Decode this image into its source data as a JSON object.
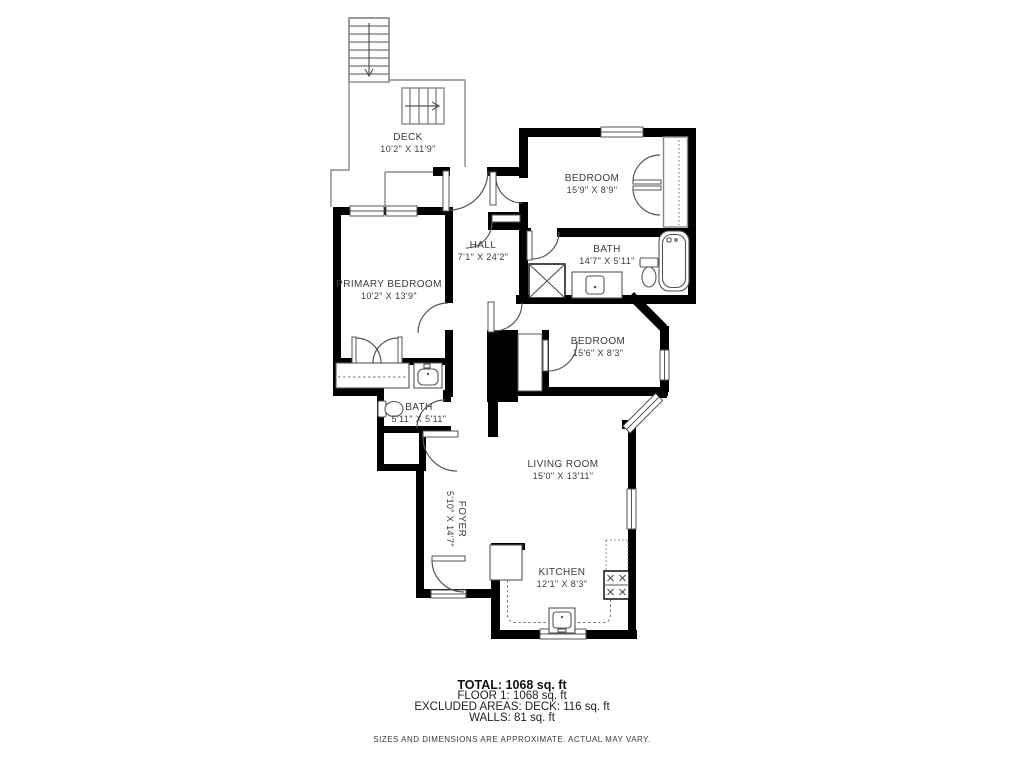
{
  "rooms": {
    "deck": {
      "name": "DECK",
      "dims": "10'2\" X 11'9\""
    },
    "bedroom_top": {
      "name": "BEDROOM",
      "dims": "15'9\" X 8'9\""
    },
    "hall": {
      "name": "HALL",
      "dims": "7'1\" X 24'2\""
    },
    "bath_top": {
      "name": "BATH",
      "dims": "14'7\" X 5'11\""
    },
    "primary_bedroom": {
      "name": "PRIMARY BEDROOM",
      "dims": "10'2\" X 13'9\""
    },
    "bedroom_mid": {
      "name": "BEDROOM",
      "dims": "15'6\" X 8'3\""
    },
    "bath_left": {
      "name": "BATH",
      "dims": "5'11\" X 5'11\""
    },
    "living_room": {
      "name": "LIVING ROOM",
      "dims": "15'0\" X 13'11\""
    },
    "foyer": {
      "name": "FOYER",
      "dims": "5'10\" X 14'7\""
    },
    "kitchen": {
      "name": "KITCHEN",
      "dims": "12'1\" X 8'3\""
    }
  },
  "summary": {
    "total": "TOTAL: 1068 sq. ft",
    "floor": "FLOOR 1: 1068 sq. ft",
    "excluded": "EXCLUDED AREAS: DECK: 116 sq. ft",
    "walls": "WALLS: 81 sq. ft",
    "disclaimer": "SIZES AND DIMENSIONS ARE APPROXIMATE. ACTUAL MAY VARY."
  },
  "palette": {
    "wall": "#000000",
    "thin_line": "#888888",
    "fixture_line": "#555555",
    "text": "#3b3b3b",
    "background": "#ffffff"
  }
}
